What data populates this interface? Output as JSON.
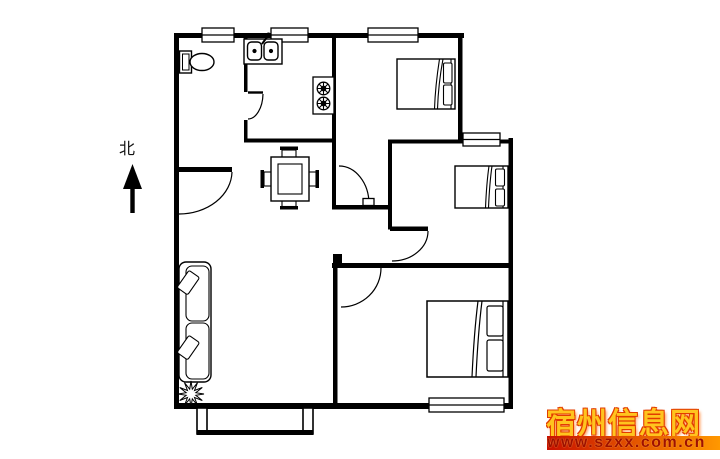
{
  "page": {
    "background": "#ffffff",
    "line_color": "#000000"
  },
  "north_indicator": {
    "label": "北"
  },
  "watermark": {
    "site_name": "宿州信息网",
    "url": "www.szxx.com.cn",
    "name_color": "#ffc41e",
    "name_outline_color": "#e23c00",
    "bar_gradient_left": "#c81000",
    "bar_gradient_right": "#ff9800",
    "url_text_color": "#a01000"
  },
  "floorplan": {
    "type": "apartment-floor-plan",
    "symbols": [
      "toilet",
      "kitchen-sink",
      "gas-stove",
      "dining-table-with-chairs",
      "double-bed",
      "single-bed",
      "double-bed",
      "sofa",
      "plant",
      "north-arrow",
      "entry-door",
      "room-doors",
      "windows",
      "entry-porch"
    ]
  }
}
